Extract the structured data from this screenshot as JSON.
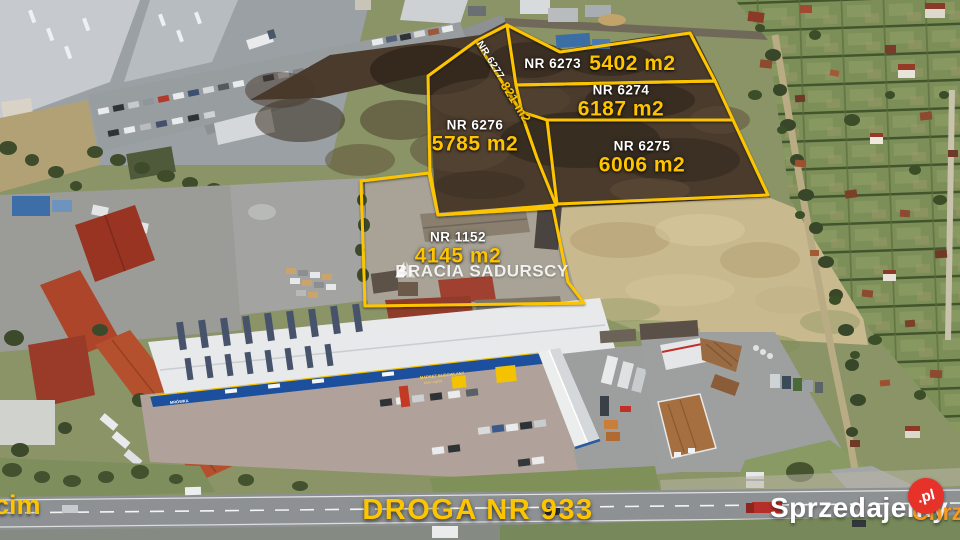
{
  "scene": {
    "description": "aerial drone photo of land plots for sale along road DW933",
    "accent_yellow": "#fdc500",
    "label_white": "#ffffff",
    "brand_red": "#e63228",
    "brand_orange": "#f6991e"
  },
  "plots": [
    {
      "id": "NR 6273",
      "area": "5402 m2"
    },
    {
      "id": "NR 6274",
      "area": "6187 m2"
    },
    {
      "id": "NR 6276",
      "area": "5785 m2"
    },
    {
      "id": "NR 6275",
      "area": "6006 m2"
    },
    {
      "id": "NR 1152",
      "area": "4145 m2"
    },
    {
      "id": "NR 6277",
      "area": "821 m2"
    }
  ],
  "watermark": {
    "left": "BRACIA",
    "right": "SADURSCY"
  },
  "road_label": "DROGA NR 933",
  "direction_left": "cim",
  "direction_right": "Chrz",
  "branding": {
    "site": "Sprzedajemy",
    "tld": ".pl"
  },
  "market": {
    "logo": "MRÓWKA",
    "sign_line1": "MARKET BUDOWLANY",
    "sign_line2": "dom i ogród"
  }
}
